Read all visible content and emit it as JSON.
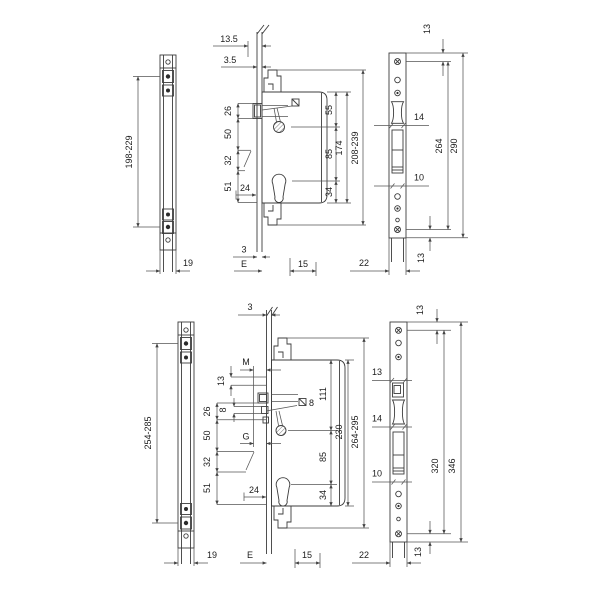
{
  "meta": {
    "drawing_type": "technical dimension drawing, multipoint lock",
    "background": "#ffffff",
    "line_color": "#3c3c3c",
    "text_color": "#1c1c1c"
  },
  "top_assembly": {
    "edge_strip": {
      "screw_span": "198-229",
      "width": "19"
    },
    "lock_case": {
      "hook_offset": "13.5",
      "face_offset": "3.5",
      "latch_height": "26",
      "latch_to_spindle": "50",
      "mid_gap": "32",
      "lower_gap": "51",
      "cyl_backset": "24",
      "top_to_spindle": "55",
      "spindle_to_cyl": "85",
      "cyl_to_bottom": "34",
      "case_height": "174",
      "overall_height": "208-239",
      "face_thickness": "3",
      "backset": "E",
      "depth": "15"
    },
    "strike_plate": {
      "top_edge": "13",
      "roller_cut": "14",
      "bolt_cut": "10",
      "screw_span": "264",
      "height": "290",
      "bottom_edge": "13",
      "width": "22"
    }
  },
  "bottom_assembly": {
    "edge_strip": {
      "screw_span": "254-285",
      "width": "19"
    },
    "lock_case": {
      "face_thickness": "3",
      "m_label": "M",
      "g_label": "G",
      "aux_height": "13",
      "latch_height": "26",
      "latch_lip": "8",
      "latch_to_spindle": "50",
      "mid_gap": "32",
      "lower_gap": "51",
      "cyl_backset": "24",
      "spindle_square": "8",
      "top_to_spindle": "111",
      "spindle_to_cyl": "85",
      "cyl_to_bottom": "34",
      "case_height": "230",
      "overall_height": "264-295",
      "backset": "E",
      "depth": "15"
    },
    "strike_plate": {
      "top_edge": "13",
      "upper_cut": "13",
      "roller_cut": "14",
      "bolt_cut": "10",
      "screw_span": "320",
      "height": "346",
      "bottom_edge": "13",
      "width": "22"
    }
  }
}
